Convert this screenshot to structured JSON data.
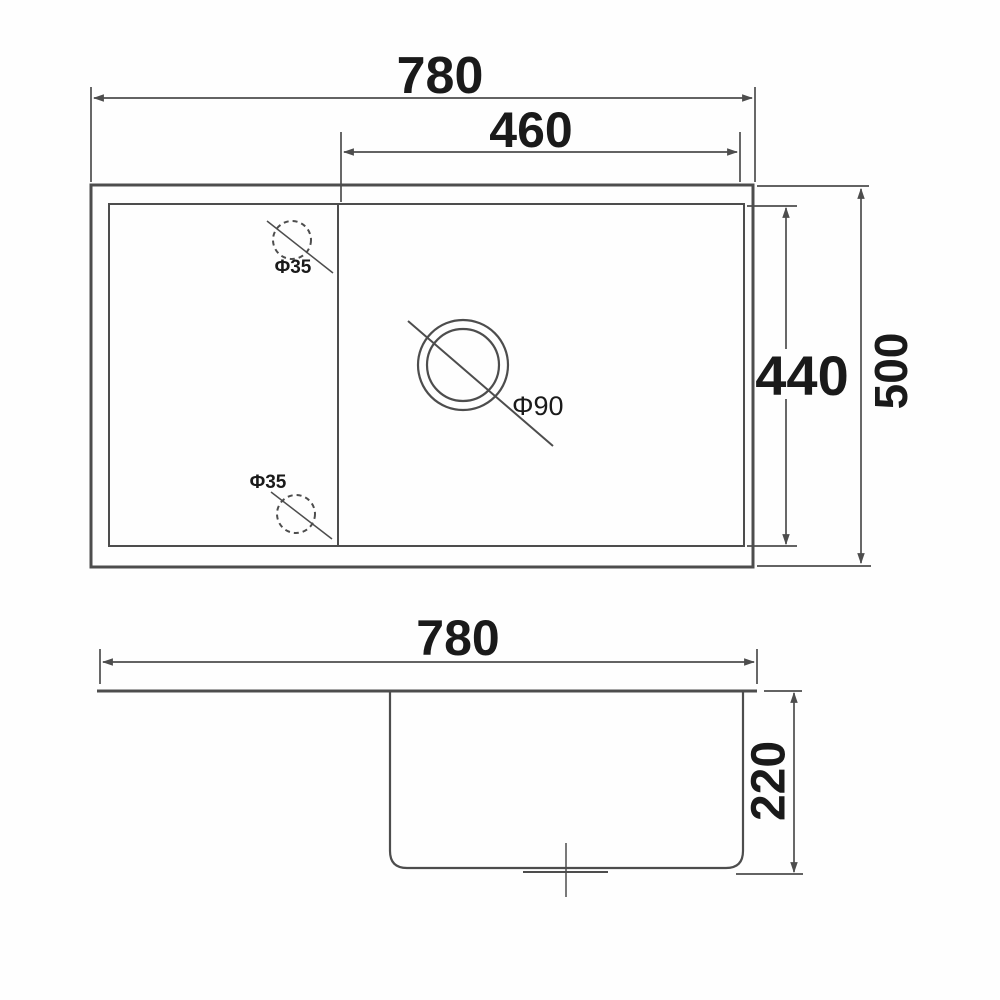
{
  "drawing_type": "sink-dimension-diagram",
  "colors": {
    "line": "#4d4d4d",
    "text": "#1a1a1a",
    "background": "#fefefe"
  },
  "top_view": {
    "overall_width_label": "780",
    "bowl_width_label": "460",
    "bowl_front_to_back_label": "440",
    "overall_depth_label": "500",
    "tap_hole_upper_label": "Φ35",
    "tap_hole_lower_label": "Φ35",
    "waste_hole_label": "Φ90"
  },
  "side_view": {
    "overall_width_label": "780",
    "bowl_depth_label": "220"
  }
}
